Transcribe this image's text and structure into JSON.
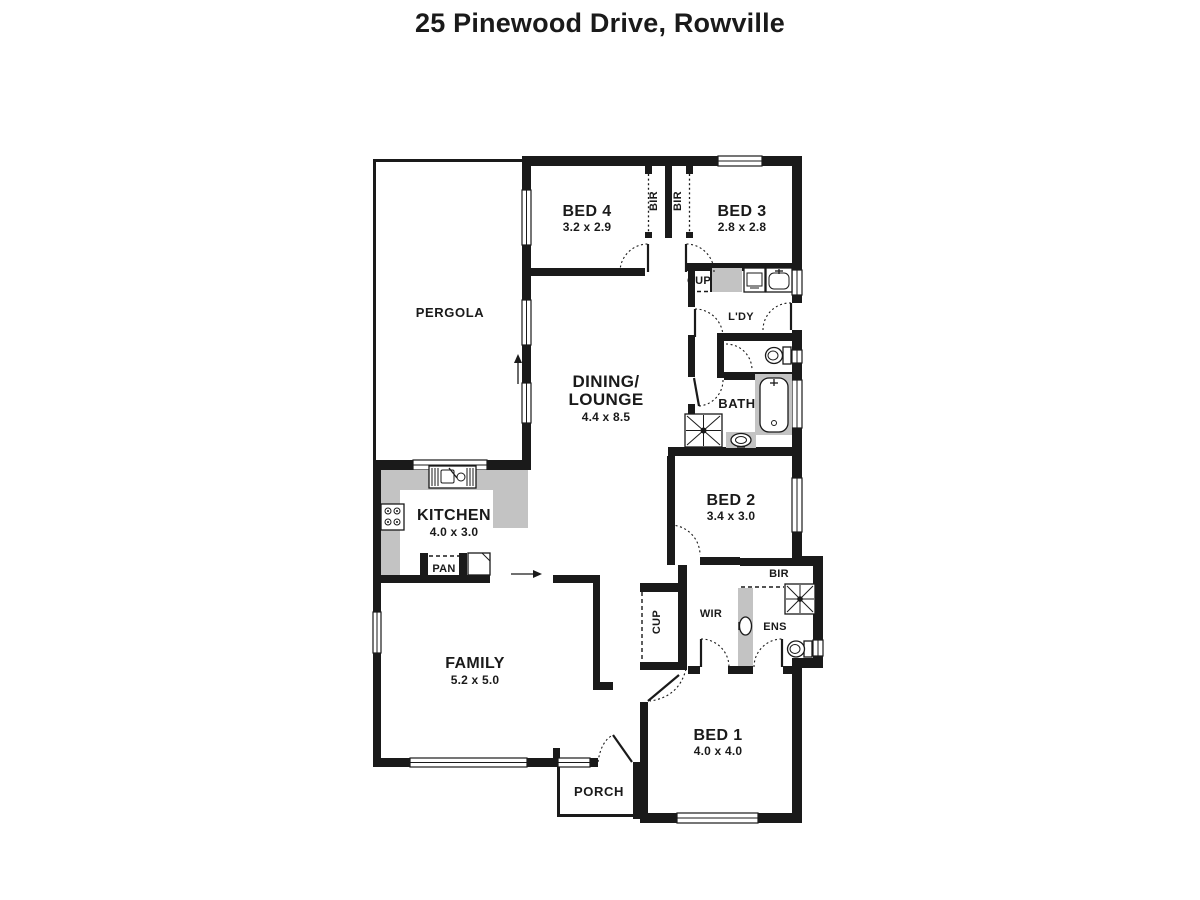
{
  "title": "25 Pinewood Drive, Rowville",
  "colors": {
    "wall": "#1a1a1a",
    "counter": "#c3c3c3",
    "background": "#ffffff"
  },
  "rooms": {
    "pergola": {
      "name": "PERGOLA"
    },
    "bed4": {
      "name": "BED 4",
      "dims": "3.2 x 2.9"
    },
    "bed3": {
      "name": "BED 3",
      "dims": "2.8 x 2.8"
    },
    "dining": {
      "name_line1": "DINING/",
      "name_line2": "LOUNGE",
      "dims": "4.4 x 8.5"
    },
    "kitchen": {
      "name": "KITCHEN",
      "dims": "4.0 x 3.0"
    },
    "family": {
      "name": "FAMILY",
      "dims": "5.2 x 5.0"
    },
    "bed2": {
      "name": "BED 2",
      "dims": "3.4 x 3.0"
    },
    "bed1": {
      "name": "BED 1",
      "dims": "4.0 x 4.0"
    },
    "bath": {
      "name": "BATH"
    },
    "laundry": {
      "name": "L'DY"
    },
    "ensuite": {
      "name": "ENS"
    },
    "wir": {
      "name": "WIR"
    },
    "porch": {
      "name": "PORCH"
    },
    "pantry": {
      "name": "PAN"
    },
    "cup_hall": {
      "name": "CUP"
    },
    "cup_entry": {
      "name": "CUP"
    },
    "bir_bed4": {
      "name": "BIR"
    },
    "bir_bed3": {
      "name": "BIR"
    },
    "bir_bed2": {
      "name": "BIR"
    }
  }
}
